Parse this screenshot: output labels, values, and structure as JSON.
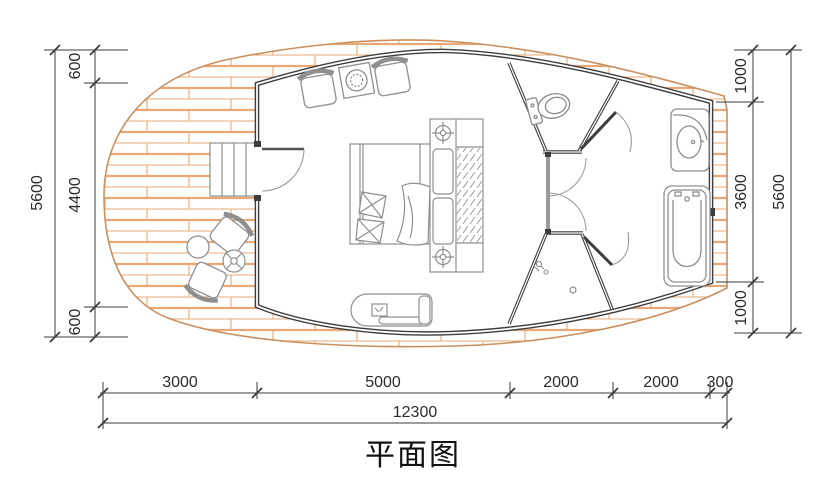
{
  "title": "平面图",
  "dimensions": {
    "left": {
      "segments": [
        "600",
        "4400",
        "600"
      ],
      "total": "5600"
    },
    "right": {
      "segments": [
        "1000",
        "3600",
        "1000"
      ],
      "total": "5600"
    },
    "bottom": {
      "segments": [
        "3000",
        "5000",
        "2000",
        "2000",
        "300"
      ],
      "total": "12300"
    }
  },
  "colors": {
    "wall": "#3d3d3d",
    "furniture": "#8f8f8f",
    "deck_hatch": "#e6a876",
    "deck_outline": "#c9905e",
    "dimension": "#3a3a3a",
    "background": "#ffffff"
  },
  "furniture": [
    "steps",
    "entry-door",
    "armchair",
    "side-table",
    "bed",
    "pillows",
    "blanket",
    "wardrobe",
    "bench",
    "toilet",
    "sink-vanity",
    "bathtub",
    "shower-drain",
    "shower-head",
    "outdoor-chair",
    "round-table",
    "cross-table"
  ]
}
